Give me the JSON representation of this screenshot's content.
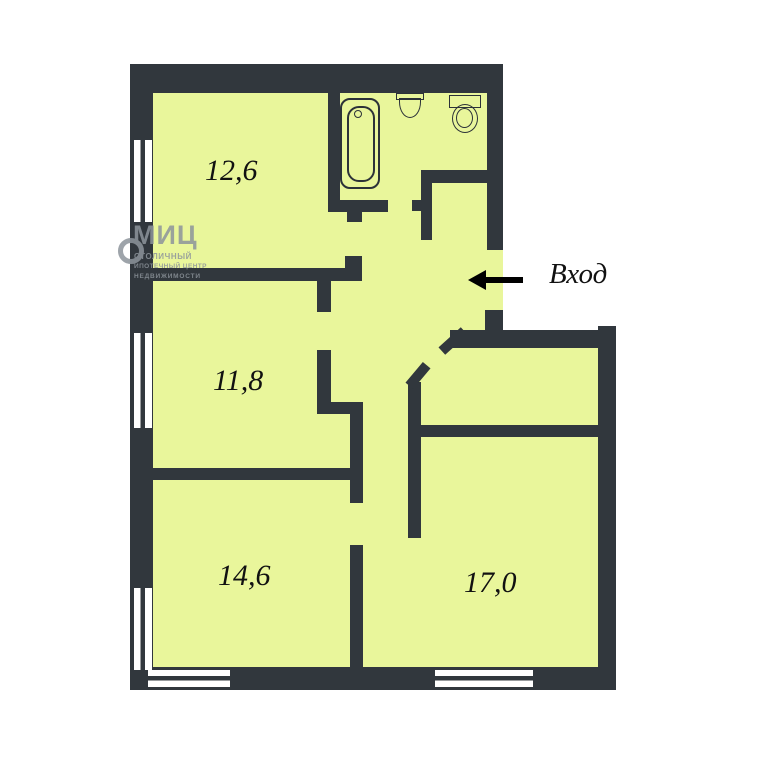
{
  "plan_title": "apartment-floor-plan",
  "rooms": [
    {
      "id": "room-top-left",
      "area": "12,6"
    },
    {
      "id": "room-mid-left",
      "area": "11,8"
    },
    {
      "id": "room-bottom-left",
      "area": "14,6"
    },
    {
      "id": "room-bottom-right",
      "area": "17,0"
    }
  ],
  "entrance": {
    "label": "Вход"
  },
  "watermark": {
    "logo": "МИЦ",
    "line1": "СТОЛИЧНЫЙ",
    "line2": "ИПОТЕЧНЫЙ ЦЕНТР",
    "line3": "НЕДВИЖИМОСТИ"
  },
  "colors": {
    "wall": "#31373d",
    "floor": "#e9f69b",
    "outline": "#2c3238",
    "ink": "#111111",
    "wm": "#8d949b"
  }
}
